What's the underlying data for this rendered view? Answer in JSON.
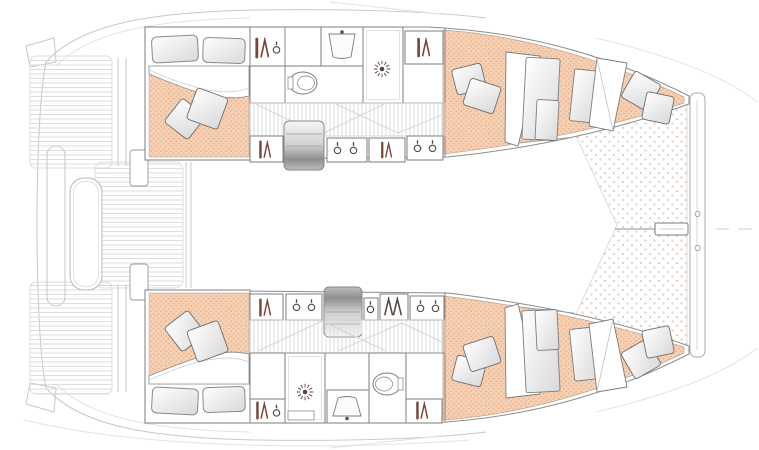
{
  "plan": {
    "title": "Catamaran interior layout — top-down floor plan",
    "vessel_type": "sailing catamaran",
    "bow_direction": "right",
    "stern_direction": "left",
    "cabin_count": 4,
    "head_count": 2,
    "hulls": [
      {
        "id": "port-hull-top",
        "rooms": [
          {
            "name": "aft double cabin",
            "items": [
              "double berth",
              "2 pillows",
              "2 scatter cushions",
              "folded duvet"
            ]
          },
          {
            "name": "head",
            "items": [
              "toilet",
              "washbasin",
              "shower stall with drain"
            ]
          },
          {
            "name": "passageway",
            "items": [
              "companionway steps",
              "hanging lockers",
              "stowage hooks",
              "timber sole"
            ]
          },
          {
            "name": "forward double cabin",
            "items": [
              "tapered berth",
              "berth cushion panels",
              "2 pillows",
              "2 scatter cushions",
              "folded duvet"
            ]
          }
        ]
      },
      {
        "id": "starboard-hull-bottom",
        "rooms": [
          {
            "name": "aft double cabin",
            "items": [
              "double berth",
              "2 pillows",
              "2 scatter cushions",
              "folded duvet"
            ]
          },
          {
            "name": "head",
            "items": [
              "shower stall with drain",
              "washbasin",
              "toilet"
            ]
          },
          {
            "name": "passageway",
            "items": [
              "companionway steps",
              "hanging lockers",
              "stowage hooks",
              "timber sole"
            ]
          },
          {
            "name": "forward double cabin",
            "items": [
              "tapered berth",
              "berth cushion panels",
              "2 pillows",
              "2 scatter cushions",
              "folded duvet"
            ]
          }
        ]
      }
    ],
    "exterior": {
      "aft": [
        "transom boarding steps",
        "cockpit sole planking",
        "cockpit bench"
      ],
      "forward": [
        "trampoline net",
        "bow crossbeam",
        "forestay fitting"
      ]
    }
  },
  "colors": {
    "mattress": "#f6d0b3",
    "mattress_dot": "#e2a37c",
    "floor_stripe": "#dcdcdc",
    "plank_line": "#d6d6d6",
    "trampoline_dot": "#ddcfc5",
    "icon": "#554640",
    "icon_accent": "#7e4339"
  },
  "icons": [
    "wardrobe-hanger-icon",
    "coat-hook-icon",
    "shower-drain-icon",
    "toilet-icon",
    "washbasin-icon",
    "companionway-steps",
    "pillow",
    "cushion",
    "trampoline",
    "bow-crossbeam",
    "forestay-fitting"
  ]
}
